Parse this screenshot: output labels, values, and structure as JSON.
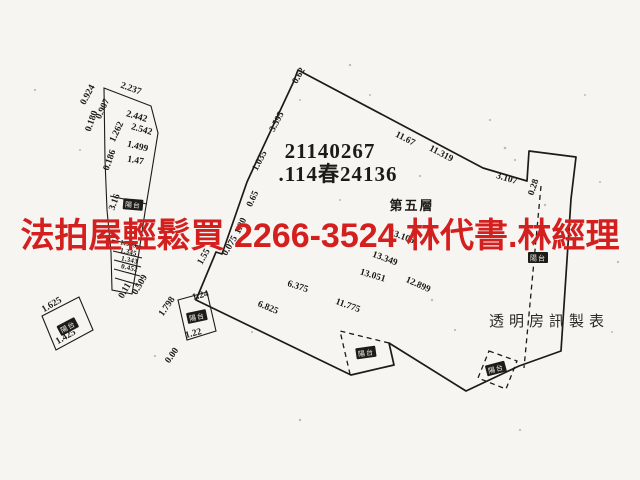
{
  "ad_overlay": {
    "text": "法拍屋輕鬆買 2266-3524 林代書.林經理",
    "color": "#d41f1f"
  },
  "plan": {
    "registration_number": "21140267",
    "case_number": ".114春24136",
    "floor_label": "第五層",
    "publisher_label": "透明房訊製表",
    "balcony_label": "陽台",
    "labels": [
      {
        "name": "registration-number",
        "cls": "code",
        "text": "21140267",
        "x": 330,
        "y": 158,
        "r": 0
      },
      {
        "name": "case-number",
        "cls": "code",
        "text": ".114春24136",
        "x": 338,
        "y": 181,
        "r": 0
      },
      {
        "name": "floor-level-label",
        "cls": "floor",
        "text": "第五層",
        "x": 412,
        "y": 210,
        "r": 0
      },
      {
        "name": "publisher-watermark",
        "cls": "pub",
        "text": "透明房訊製表",
        "x": 549,
        "y": 326,
        "r": 0
      },
      {
        "name": "dim-0-62",
        "cls": "dim",
        "text": "0.62",
        "x": 301,
        "y": 77,
        "r": -60
      },
      {
        "name": "dim-3-595",
        "cls": "dim",
        "text": "3.595",
        "x": 279,
        "y": 123,
        "r": -62
      },
      {
        "name": "dim-1-035",
        "cls": "dim",
        "text": "1.035",
        "x": 262,
        "y": 162,
        "r": -62
      },
      {
        "name": "dim-0-65",
        "cls": "dim",
        "text": "0.65",
        "x": 255,
        "y": 200,
        "r": -65
      },
      {
        "name": "dim-1-80",
        "cls": "dim",
        "text": "1.80",
        "x": 243,
        "y": 227,
        "r": -65
      },
      {
        "name": "dim-0-075",
        "cls": "dim",
        "text": "0.075",
        "x": 232,
        "y": 247,
        "r": -60
      },
      {
        "name": "dim-1-55",
        "cls": "dim",
        "text": "1.55",
        "x": 206,
        "y": 258,
        "r": -60
      },
      {
        "name": "dim-11-67",
        "cls": "dim",
        "text": "11.67",
        "x": 404,
        "y": 141,
        "r": 27
      },
      {
        "name": "dim-11-319",
        "cls": "dim",
        "text": "11.319",
        "x": 440,
        "y": 156,
        "r": 27
      },
      {
        "name": "dim-3-107",
        "cls": "dim",
        "text": "3.107",
        "x": 506,
        "y": 181,
        "r": 17
      },
      {
        "name": "dim-0-28",
        "cls": "dim",
        "text": "0.28",
        "x": 536,
        "y": 188,
        "r": -72
      },
      {
        "name": "dim-13-106",
        "cls": "dim",
        "text": "13.106",
        "x": 401,
        "y": 239,
        "r": 20
      },
      {
        "name": "dim-13-349",
        "cls": "dim",
        "text": "13.349",
        "x": 384,
        "y": 261,
        "r": 20
      },
      {
        "name": "dim-13-051",
        "cls": "dim",
        "text": "13.051",
        "x": 372,
        "y": 278,
        "r": 17
      },
      {
        "name": "dim-12-899",
        "cls": "dim",
        "text": "12.899",
        "x": 417,
        "y": 287,
        "r": 24
      },
      {
        "name": "dim-6-375",
        "cls": "dim",
        "text": "6.375",
        "x": 297,
        "y": 289,
        "r": 18
      },
      {
        "name": "dim-6-825",
        "cls": "dim",
        "text": "6.825",
        "x": 267,
        "y": 310,
        "r": 22
      },
      {
        "name": "dim-11-775",
        "cls": "dim",
        "text": "11.775",
        "x": 347,
        "y": 308,
        "r": 20
      },
      {
        "name": "balcony-main-bottom",
        "cls": "bal",
        "text": "陽台",
        "x": 366,
        "y": 353,
        "r": -8
      },
      {
        "name": "balcony-main-right",
        "cls": "bal",
        "text": "陽台",
        "x": 538,
        "y": 258,
        "r": 0
      },
      {
        "name": "balcony-main-corner",
        "cls": "bal",
        "text": "陽台",
        "x": 496,
        "y": 369,
        "r": -15
      },
      {
        "name": "dim-0-924",
        "cls": "dim",
        "text": "0.924",
        "x": 90,
        "y": 96,
        "r": -62
      },
      {
        "name": "dim-2-237",
        "cls": "dim",
        "text": "2.237",
        "x": 130,
        "y": 91,
        "r": 20
      },
      {
        "name": "dim-0-907",
        "cls": "dim",
        "text": "0.907",
        "x": 105,
        "y": 110,
        "r": -65
      },
      {
        "name": "dim-0-180",
        "cls": "dim",
        "text": "0.180",
        "x": 94,
        "y": 122,
        "r": -70
      },
      {
        "name": "dim-2-442",
        "cls": "dim",
        "text": "2.442",
        "x": 136,
        "y": 119,
        "r": 16
      },
      {
        "name": "dim-2-542",
        "cls": "dim",
        "text": "2.542",
        "x": 141,
        "y": 132,
        "r": 16
      },
      {
        "name": "dim-1-262",
        "cls": "dim",
        "text": "1.262",
        "x": 119,
        "y": 133,
        "r": -65
      },
      {
        "name": "dim-1-499",
        "cls": "dim",
        "text": "1.499",
        "x": 137,
        "y": 149,
        "r": 14
      },
      {
        "name": "dim-0-186",
        "cls": "dim",
        "text": "0.186",
        "x": 112,
        "y": 161,
        "r": -70
      },
      {
        "name": "dim-1-47",
        "cls": "dim",
        "text": "1.47",
        "x": 135,
        "y": 163,
        "r": 10
      },
      {
        "name": "dim-3-16",
        "cls": "dim",
        "text": "3.16",
        "x": 117,
        "y": 203,
        "r": -70
      },
      {
        "name": "balcony-strip",
        "cls": "bal",
        "text": "陽台",
        "x": 133,
        "y": 205,
        "r": 5
      },
      {
        "name": "dim-1-343a",
        "cls": "dimsm",
        "text": "1.343",
        "x": 128,
        "y": 246,
        "r": 12
      },
      {
        "name": "dim-1-345",
        "cls": "dimsm",
        "text": "1.345",
        "x": 128,
        "y": 254,
        "r": 12
      },
      {
        "name": "dim-1-343b",
        "cls": "dimsm",
        "text": "1.343",
        "x": 129,
        "y": 262,
        "r": 12
      },
      {
        "name": "dim-0-452",
        "cls": "dimsm",
        "text": "0.452",
        "x": 129,
        "y": 270,
        "r": 12
      },
      {
        "name": "dim-0-11",
        "cls": "dim",
        "text": "0.11",
        "x": 127,
        "y": 292,
        "r": -60
      },
      {
        "name": "dim-0-509",
        "cls": "dim",
        "text": "0.509",
        "x": 142,
        "y": 286,
        "r": -60
      },
      {
        "name": "dim-1-625",
        "cls": "dim",
        "text": "1.625",
        "x": 53,
        "y": 307,
        "r": -30
      },
      {
        "name": "balcony-sq1",
        "cls": "bal",
        "text": "陽台",
        "x": 68,
        "y": 327,
        "r": -28
      },
      {
        "name": "dim-1-425",
        "cls": "dim",
        "text": "1.425",
        "x": 67,
        "y": 339,
        "r": -30
      },
      {
        "name": "dim-1-798",
        "cls": "dim",
        "text": "1.798",
        "x": 169,
        "y": 308,
        "r": -55
      },
      {
        "name": "dim-1-24",
        "cls": "dim",
        "text": "1.24",
        "x": 201,
        "y": 298,
        "r": -15
      },
      {
        "name": "balcony-sq2",
        "cls": "bal",
        "text": "陽台",
        "x": 197,
        "y": 317,
        "r": -12
      },
      {
        "name": "dim-1-22",
        "cls": "dim",
        "text": "1.22",
        "x": 194,
        "y": 336,
        "r": -15
      },
      {
        "name": "dim-0-00",
        "cls": "dim",
        "text": "0.00",
        "x": 174,
        "y": 357,
        "r": -55
      }
    ]
  },
  "colors": {
    "paper": "#f6f5f1",
    "ink": "#1c1b17",
    "accent_red": "#d41f1f"
  }
}
